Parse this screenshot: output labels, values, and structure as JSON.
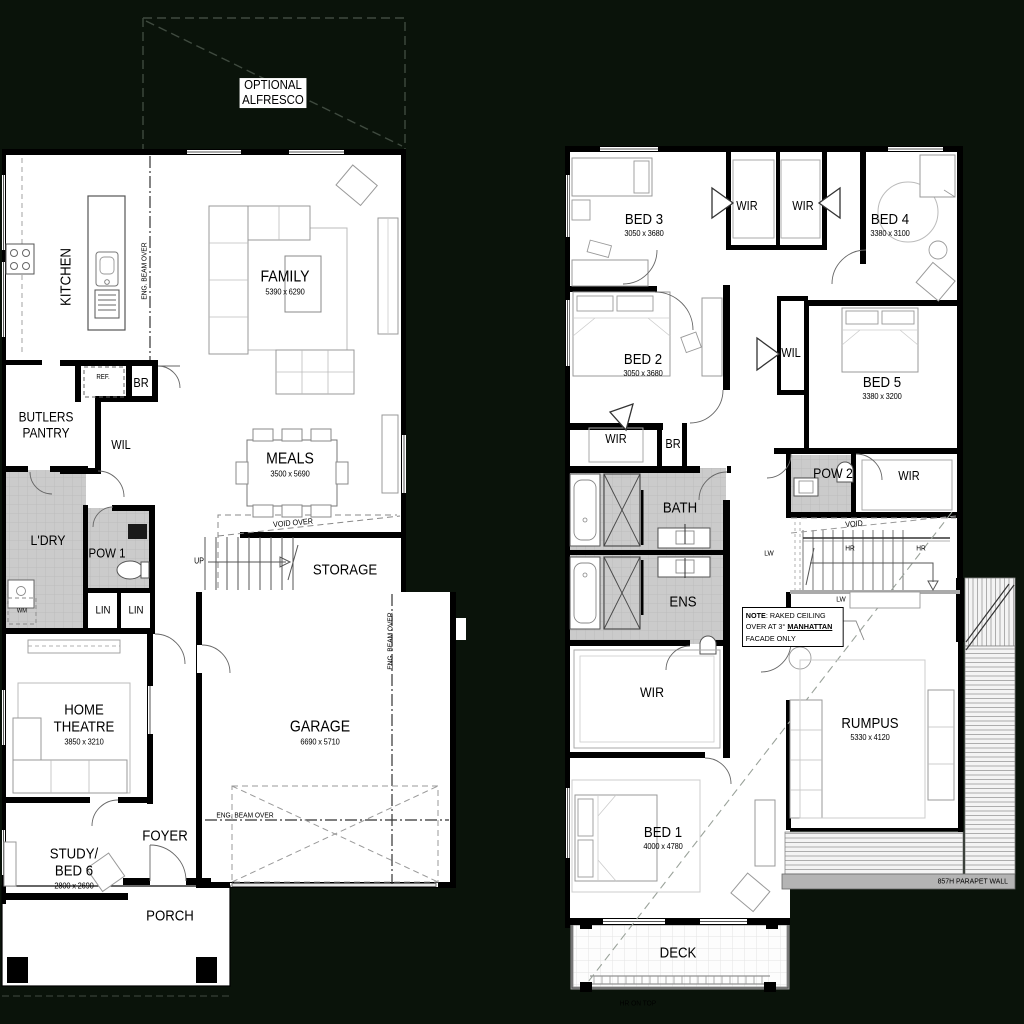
{
  "colors": {
    "background": "#0a130a",
    "floor": "#ffffff",
    "wall": "#000000",
    "tile_grey": "#cbcbcb",
    "parapet_grey": "#b4b4b4"
  },
  "shared": {
    "wir": "WIR",
    "wil": "WIL",
    "lin": "LIN",
    "br": "BR",
    "lw": "LW",
    "hr": "HR",
    "up": "UP",
    "wm": "WM",
    "ref": "REF.",
    "void": "VOID",
    "void_over": "VOID OVER",
    "eng_beam_over": "ENG. BEAM OVER"
  },
  "ground_floor": {
    "optional_alfresco": "OPTIONAL ALFRESCO",
    "kitchen": "KITCHEN",
    "family": {
      "name": "FAMILY",
      "dim": "5390 x 6290"
    },
    "butlers_pantry": "BUTLERS PANTRY",
    "meals": {
      "name": "MEALS",
      "dim": "3500 x 5690"
    },
    "laundry": "L'DRY",
    "pow1": "POW 1",
    "storage": "STORAGE",
    "home_theatre": {
      "name": "HOME THEATRE",
      "dim": "3850 x 3210"
    },
    "garage": {
      "name": "GARAGE",
      "dim": "6690 x 5710"
    },
    "study_bed6": {
      "name": "STUDY/ BED 6",
      "dim": "2800 x 2690"
    },
    "foyer": "FOYER",
    "porch": "PORCH"
  },
  "first_floor": {
    "bed1": {
      "name": "BED 1",
      "dim": "4000 x 4780"
    },
    "bed2": {
      "name": "BED 2",
      "dim": "3050 x 3680"
    },
    "bed3": {
      "name": "BED 3",
      "dim": "3050 x 3680"
    },
    "bed4": {
      "name": "BED 4",
      "dim": "3380 x 3100"
    },
    "bed5": {
      "name": "BED 5",
      "dim": "3380 x 3200"
    },
    "bath": "BATH",
    "ens": "ENS",
    "pow2": "POW 2",
    "rumpus": {
      "name": "RUMPUS",
      "dim": "5330 x 4120"
    },
    "deck": "DECK",
    "parapet_wall": "857H PARAPET WALL",
    "hr_on_top": "HR ON TOP",
    "note": {
      "label": "NOTE",
      "line1": ": RAKED CEILING",
      "line2_pre": "OVER AT 3° ",
      "line2_bold": "MANHATTAN",
      "line3": "FACADE ONLY"
    }
  }
}
